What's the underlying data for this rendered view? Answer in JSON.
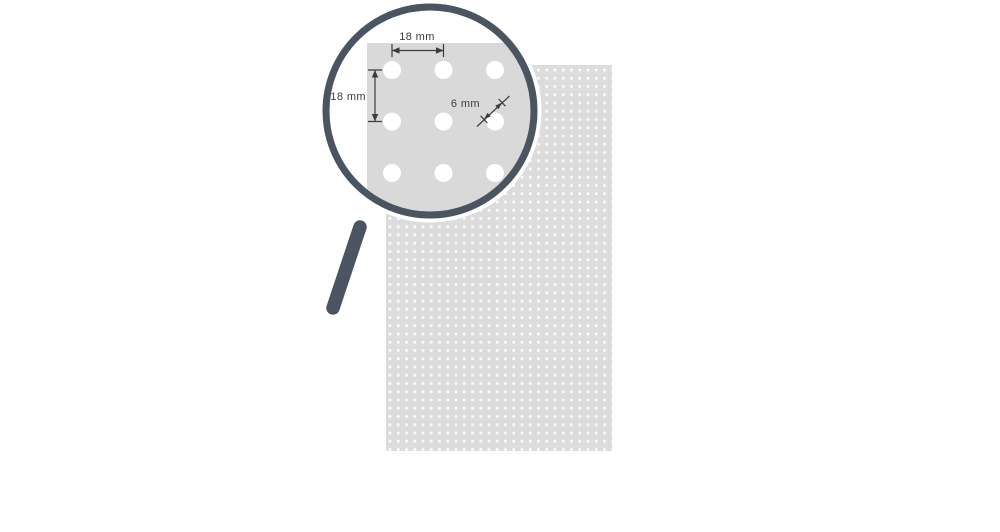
{
  "scene": {
    "title": "Perforated panel hole pattern with magnifier detail",
    "colors": {
      "background": "#ffffff",
      "panel_fill": "#dcdcdc",
      "panel_dot": "#fafafa",
      "magnifier_metal": "#4a5561",
      "lens_fill": "#ffffff",
      "sheet_fill": "#d9d9d9",
      "hole_fill": "#ffffff",
      "dimension": "#3c3c3c"
    },
    "annotations": {
      "pitch_horizontal": {
        "label": "18 mm"
      },
      "pitch_vertical": {
        "label": "18 mm"
      },
      "hole_diameter": {
        "label": "6 mm"
      }
    }
  }
}
